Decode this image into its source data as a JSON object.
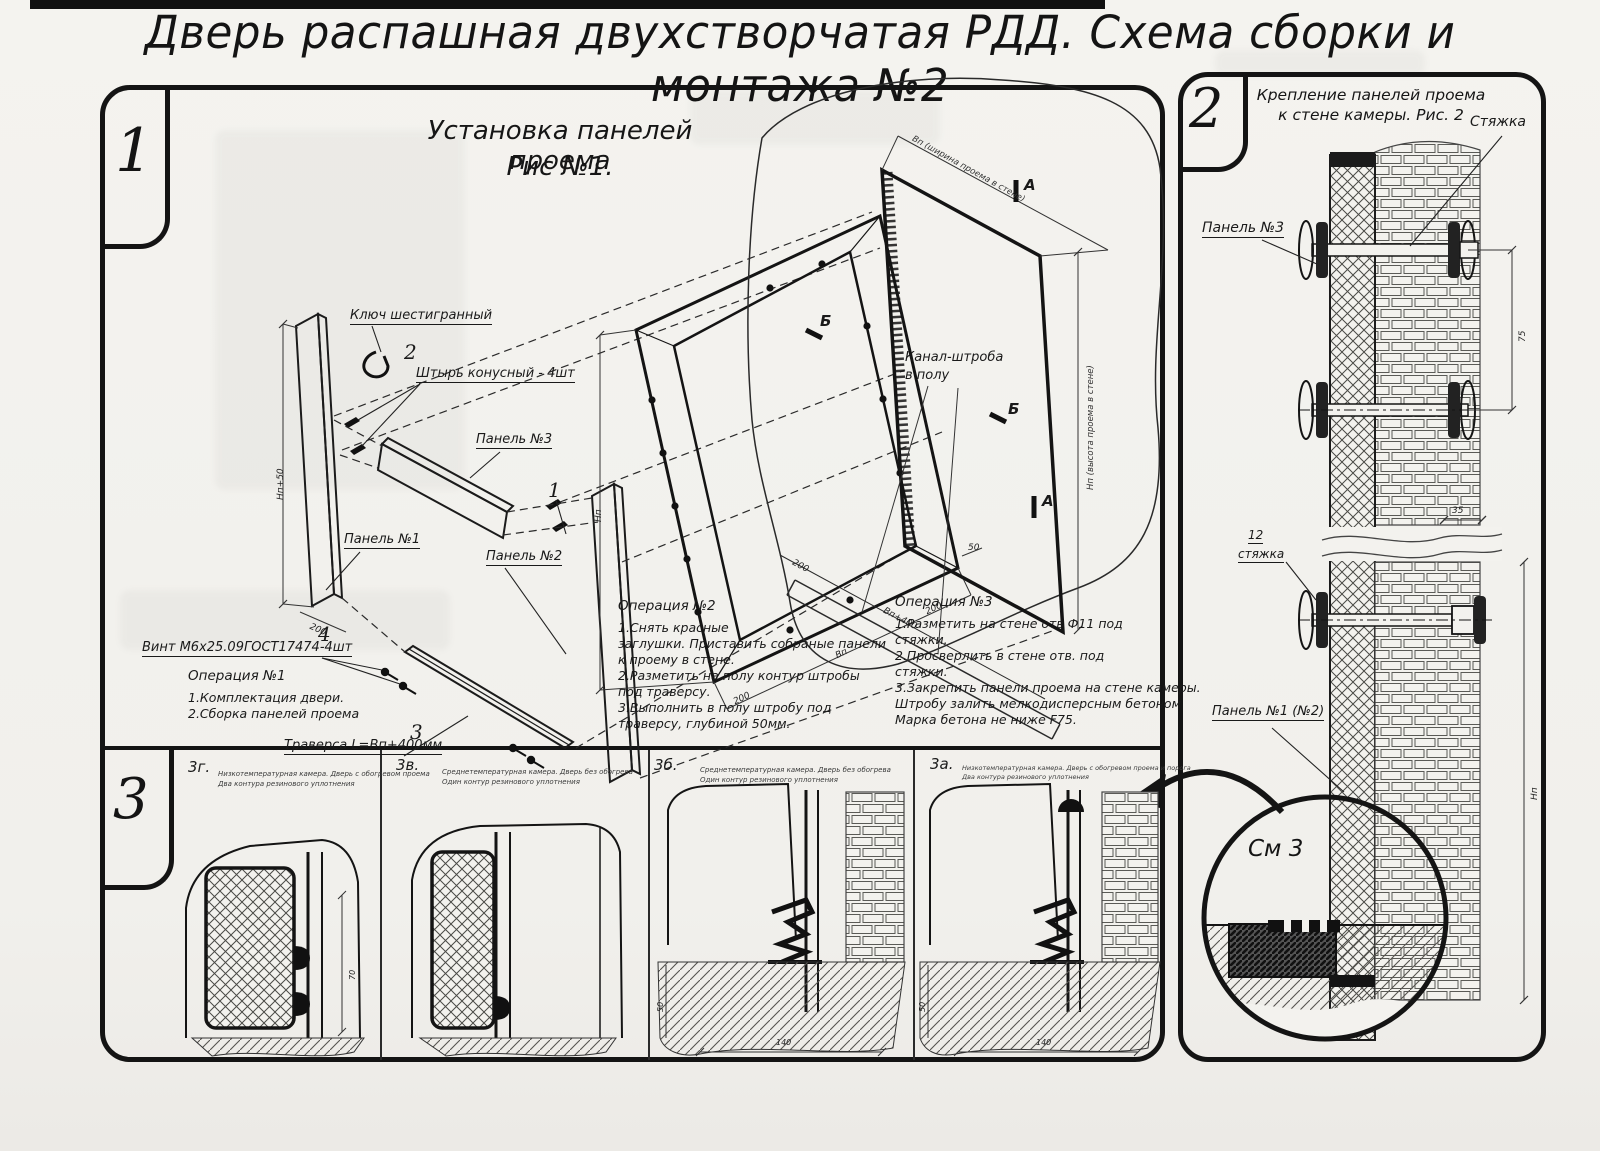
{
  "title": "Дверь распашная двухстворчатая РДД.  Схема сборки и монтажа №2",
  "figure1": {
    "number": "1",
    "title1": "Установка панелей проема",
    "title2": "Рис №1.",
    "labels": {
      "hex_key": "Ключ шестигранный",
      "pin_no": "2",
      "pin": "Штырь конусный - 4шт",
      "panel3": "Панель №3",
      "panel1": "Панель №1",
      "panel2": "Панель №2",
      "item1": "1",
      "screw_no": "4",
      "screw": "Винт М6х25.09ГОСТ17474-4шт",
      "trav_no": "3",
      "traverse": "Траверса  L=Вп+400мм",
      "channel1": "Канал-штроба",
      "channel2": "в полу",
      "cut_a": "А",
      "cut_a2": "А",
      "cut_b": "Б",
      "cut_b2": "Б"
    },
    "dims": {
      "np50": "Нп+50",
      "d200a": "200",
      "np": "Нп",
      "d200b": "200",
      "vp": "Вп",
      "d200c": "200",
      "vp400": "Вп+400",
      "d200d": "200",
      "d50": "50",
      "open_w": "Вп (ширина проема в стене)",
      "open_h": "Нп (высота проема в стене)"
    },
    "op1": {
      "title": "Операция №1",
      "l1": "1.Комплектация двери.",
      "l2": "2.Сборка панелей проема"
    },
    "op2": {
      "title": "Операция №2",
      "l1": "1.Снять красные",
      "l2": "заглушки. Приставить собраные панели",
      "l3": "к проему в стене.",
      "l4": "2.Разметить на полу контур штробы",
      "l5": "под траверсу.",
      "l6": "3.Выполнить в полу штробу под",
      "l7": "траверсу, глубиной 50мм."
    },
    "op3": {
      "title": "Операция №3",
      "l1": "1.Разметить на стене отв Ф11 под",
      "l2": "стяжки.",
      "l3": "2.Просверлить в стене отв.  под",
      "l4": "стяжки.",
      "l5": "3.Закрепить панели проема на стене камеры.",
      "l6": "Штробу залить мелкодисперсным бетоном",
      "l7": "Марка бетона не ниже   F75."
    }
  },
  "figure2": {
    "number": "2",
    "title1": "Крепление панелей проема",
    "title2": "к стене камеры. Рис. 2",
    "labels": {
      "tie": "Стяжка",
      "panel3": "Панель №3",
      "tie12_no": "12",
      "tie12": "стяжка",
      "panel12": "Панель №1 (№2)",
      "see3": "См 3"
    },
    "dims": {
      "d35": "35",
      "d75": "75",
      "h": "Нп"
    }
  },
  "figure3": {
    "number": "3",
    "views": [
      {
        "id": "3г.",
        "cap1": "Низкотемпературная камера. Дверь с обогревом проема",
        "cap2": "Два контура резинового уплотнения",
        "dim1": "70"
      },
      {
        "id": "3в.",
        "cap1": "Среднетемпературная камера. Дверь без обогрева",
        "cap2": "Один контур резинового уплотнения"
      },
      {
        "id": "3б.",
        "cap1": "Среднетемпературная камера. Дверь без обогрева",
        "cap2": "Один контур резинового уплотнения",
        "dim1": "50",
        "dim2": "140"
      },
      {
        "id": "3а.",
        "cap1": "Низкотемпературная камера. Дверь с обогревом проема и порога",
        "cap2": "Два контура резинового уплотнения",
        "dim1": "50",
        "dim2": "140"
      }
    ]
  }
}
